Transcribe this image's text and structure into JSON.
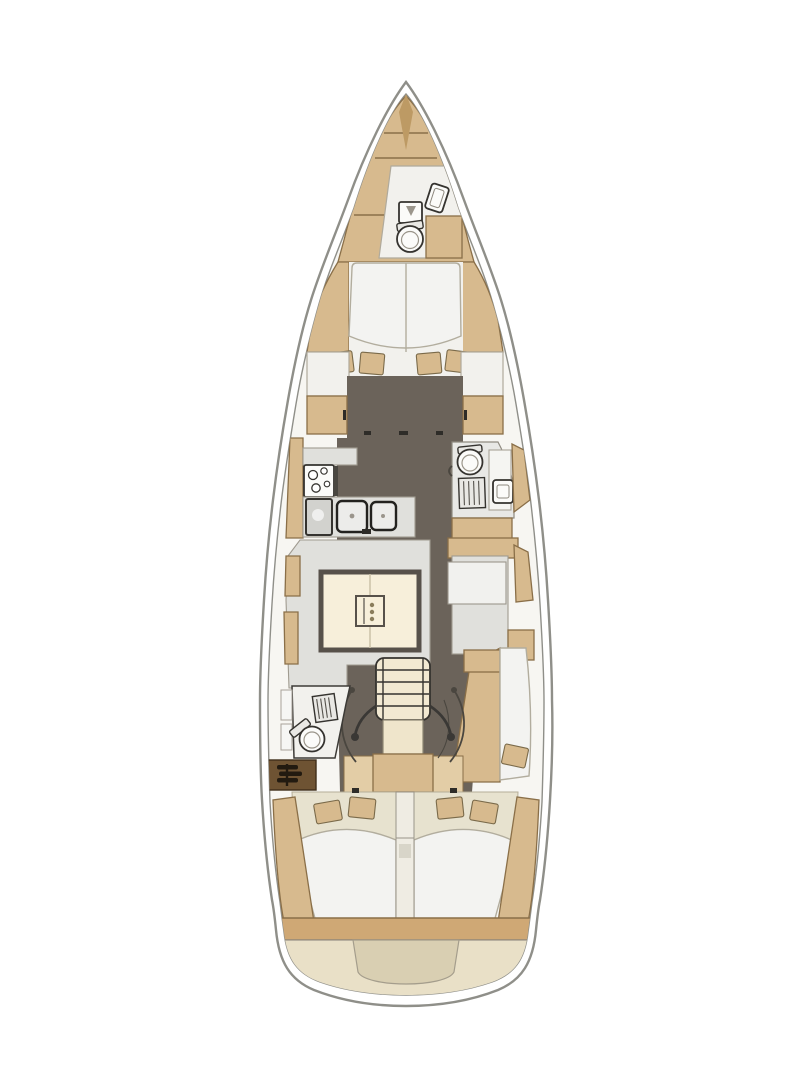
{
  "figure": {
    "type": "yacht-interior-floor-plan",
    "view": "top-down",
    "orientation": "bow-up",
    "title": "Sailing yacht interior layout plan, bow up"
  },
  "palette": {
    "background": "#ffffff",
    "hullLine": "#8f8f89",
    "deck": "#f7f6f2",
    "wood": "#d7ba8e",
    "woodLight": "#e3cda6",
    "woodDark": "#bd9a64",
    "wall": "#8a6f48",
    "floorDark": "#6b635a",
    "floorWhite": "#f2f1ed",
    "grayLight": "#e0e0dc",
    "grayMid": "#d2d2ce",
    "cream": "#f7efda",
    "beige": "#e9e0c7",
    "beigeDark": "#d9cfb2",
    "linen": "#e7e2cf",
    "duvet": "#f3f3f1",
    "cabinetBrown": "#6e5333",
    "outlineDark": "#35332f",
    "white": "#fcfcfb"
  },
  "compartments": [
    {
      "id": "anchor-locker"
    },
    {
      "id": "forward-head"
    },
    {
      "id": "forward-cabin-v-berth"
    },
    {
      "id": "galley-port"
    },
    {
      "id": "starboard-head"
    },
    {
      "id": "salon-settee-and-table"
    },
    {
      "id": "starboard-settee"
    },
    {
      "id": "companionway"
    },
    {
      "id": "port-aft-head"
    },
    {
      "id": "engine-compartment"
    },
    {
      "id": "aft-cabin-port"
    },
    {
      "id": "aft-cabin-starboard"
    },
    {
      "id": "transom-swim-platform"
    }
  ],
  "fixtures": [
    "toilet",
    "washbasin",
    "shower-grate",
    "stove-burners",
    "double-sink",
    "refrigerator",
    "salon-table",
    "bottle-holder",
    "companionway-steps",
    "handrails",
    "door-swing-arcs",
    "v-berth",
    "double-berth",
    "pillows",
    "engine-symbol",
    "anchor-locker-hatch"
  ]
}
